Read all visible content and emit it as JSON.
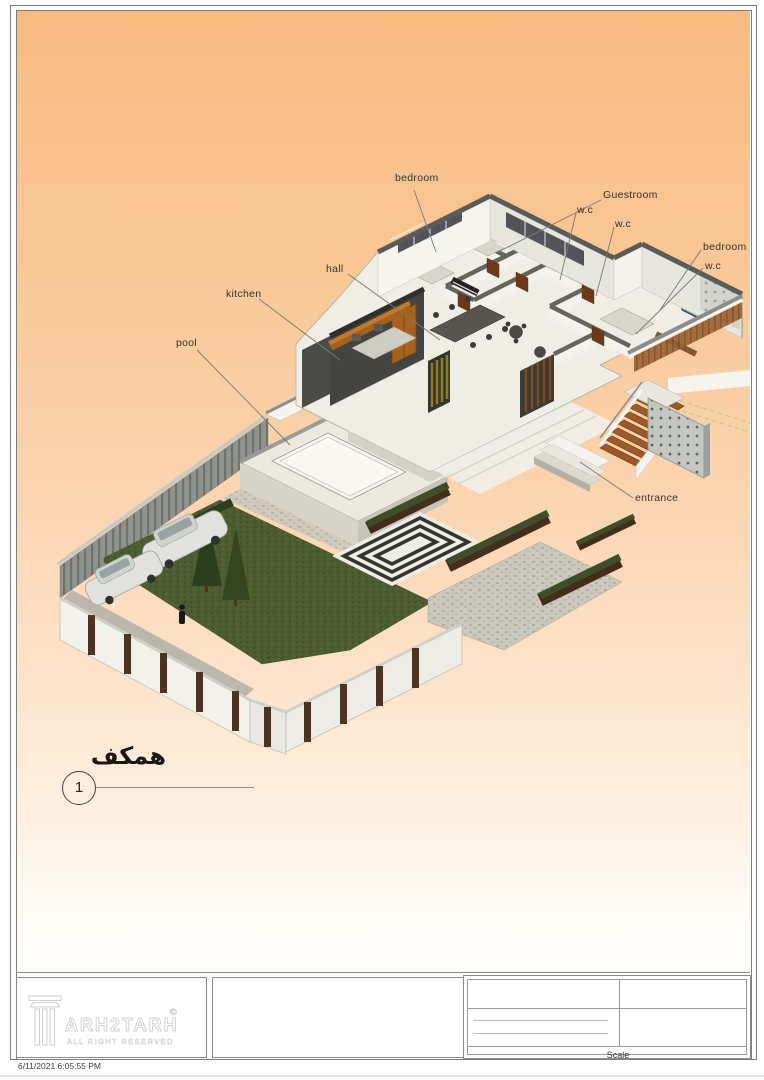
{
  "sheet": {
    "viewport_labels": {
      "bedroom_top": "bedroom",
      "guestroom": "Guestroom",
      "wc_top_left": "w.c",
      "wc_top_right": "w.c",
      "bedroom_right": "bedroom",
      "wc_right": "w.c",
      "hall": "hall",
      "kitchen": "kitchen",
      "pool": "pool",
      "entrance": "entrance"
    },
    "floor_callout": {
      "title": "همکف",
      "number": "1"
    },
    "title_block": {
      "brand": "ARH2TARH",
      "copyright_symbol": "©",
      "tagline": "ALL RIGHT RESERVED",
      "scale_label": "Scale"
    },
    "timestamp": "6/11/2021 6:05:55 PM",
    "colors": {
      "background_top": "#f8bb82",
      "background_bottom": "#fffdfa",
      "wall_light": "#f4f3ed",
      "wall_top_gray": "#5b5b58",
      "wood_accent": "#a8621c",
      "stair_wood": "#9c5a28",
      "grass_green": "#4d5c31",
      "planter_brown": "#452c1b"
    }
  }
}
